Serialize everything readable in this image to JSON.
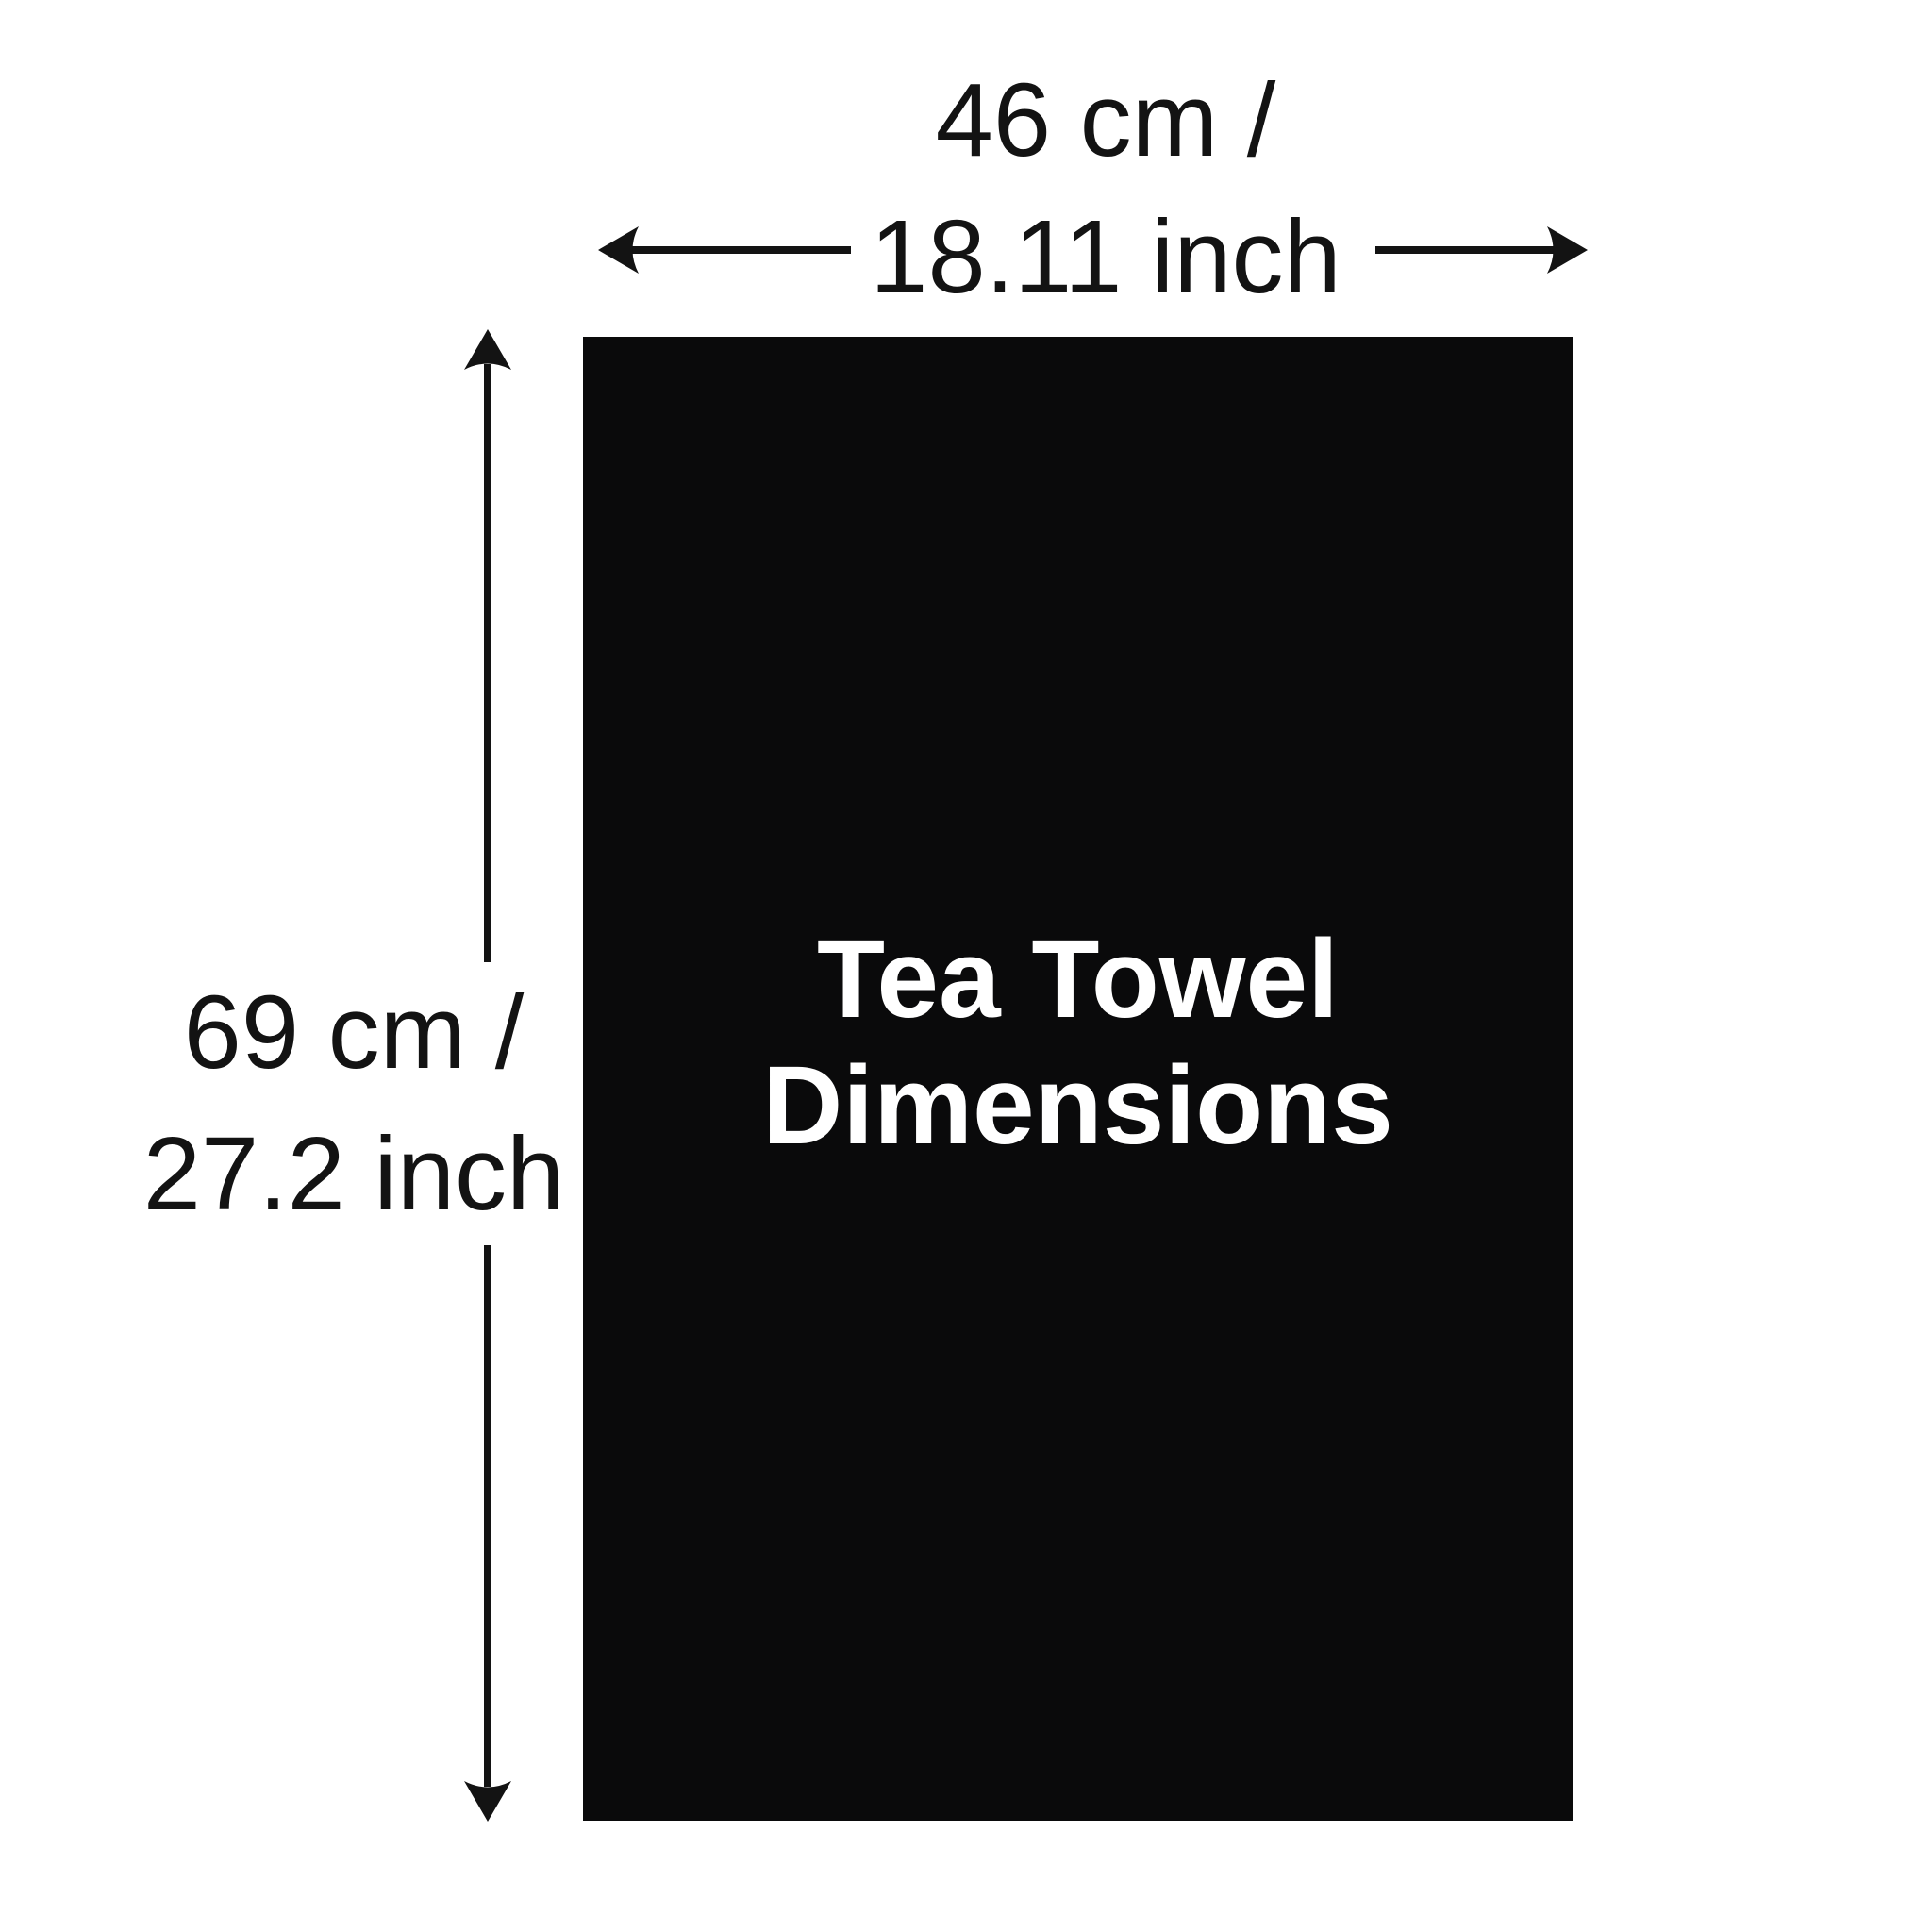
{
  "page": {
    "background": "#ffffff",
    "ink": "#131313"
  },
  "towel": {
    "title_line1": "Tea Towel",
    "title_line2": "Dimensions",
    "fill": "#0a0a0b",
    "text_color": "#ffffff"
  },
  "width_dimension": {
    "line1": "46 cm /",
    "line2": "18.11 inch",
    "cm": 46,
    "inch": 18.11
  },
  "height_dimension": {
    "line1": "69 cm /",
    "line2": "27.2 inch",
    "cm": 69,
    "inch": 27.2
  }
}
